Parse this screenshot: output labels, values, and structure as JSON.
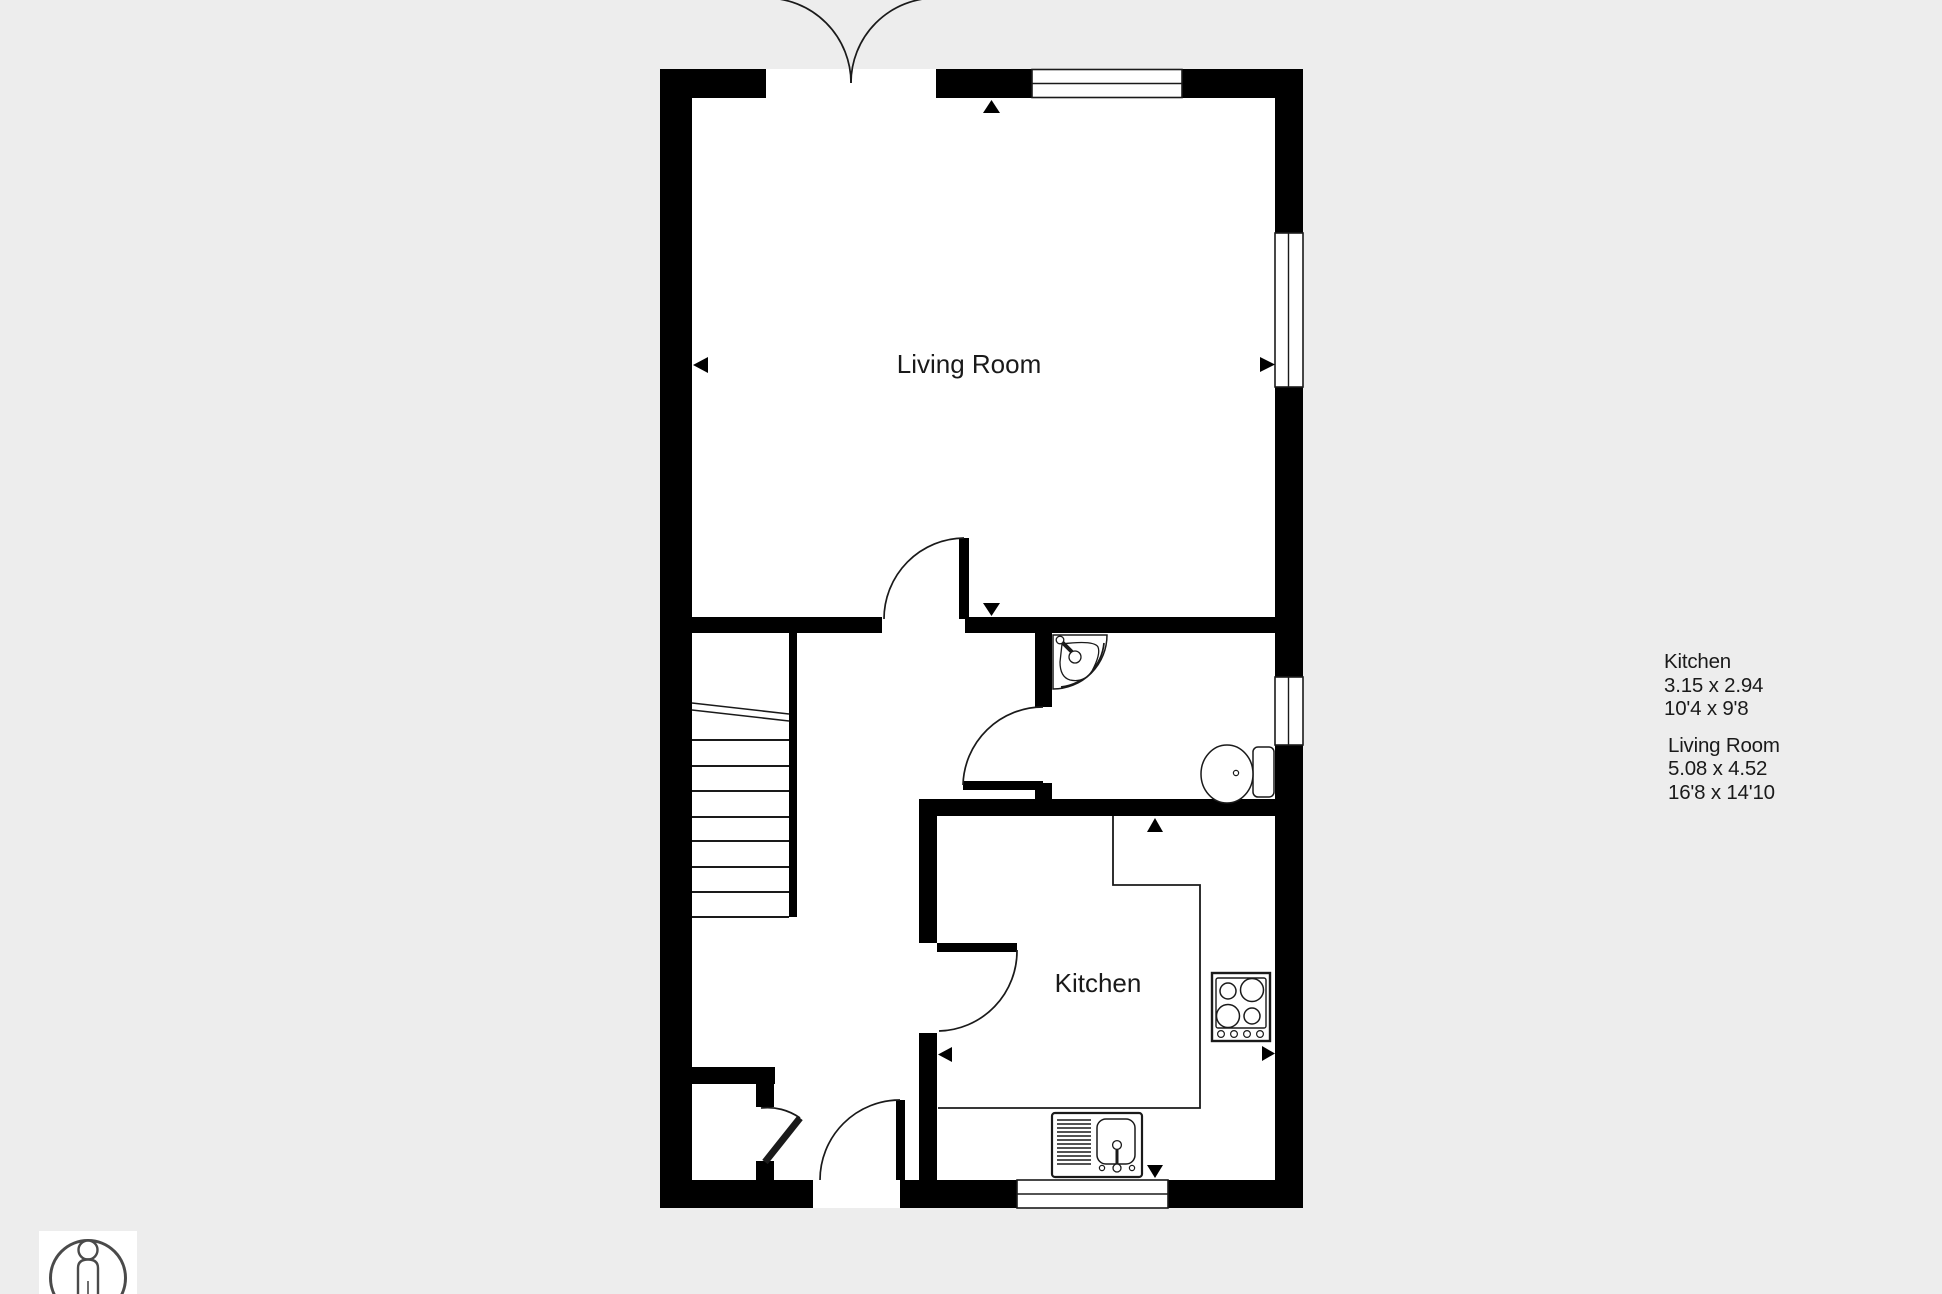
{
  "colors": {
    "background": "#ededed",
    "wall": "#000000",
    "floor": "#ffffff",
    "line": "#1a1a1a",
    "text": "#1a1a1a",
    "person": "#4a4a4a"
  },
  "plan": {
    "living_room_label": "Living Room",
    "kitchen_label": "Kitchen",
    "icons": [
      "french-doors",
      "window",
      "door-swing",
      "stairs",
      "washbasin",
      "toilet",
      "hob",
      "kitchen-sink",
      "camera-direction-triangle",
      "person-scale"
    ]
  },
  "dimensions_panel": {
    "entries": [
      {
        "name": "Kitchen",
        "metric": "3.15 x 2.94",
        "imperial": "10'4 x 9'8"
      },
      {
        "name": "Living Room",
        "metric": "5.08 x 4.52",
        "imperial": "16'8 x 14'10"
      }
    ]
  }
}
